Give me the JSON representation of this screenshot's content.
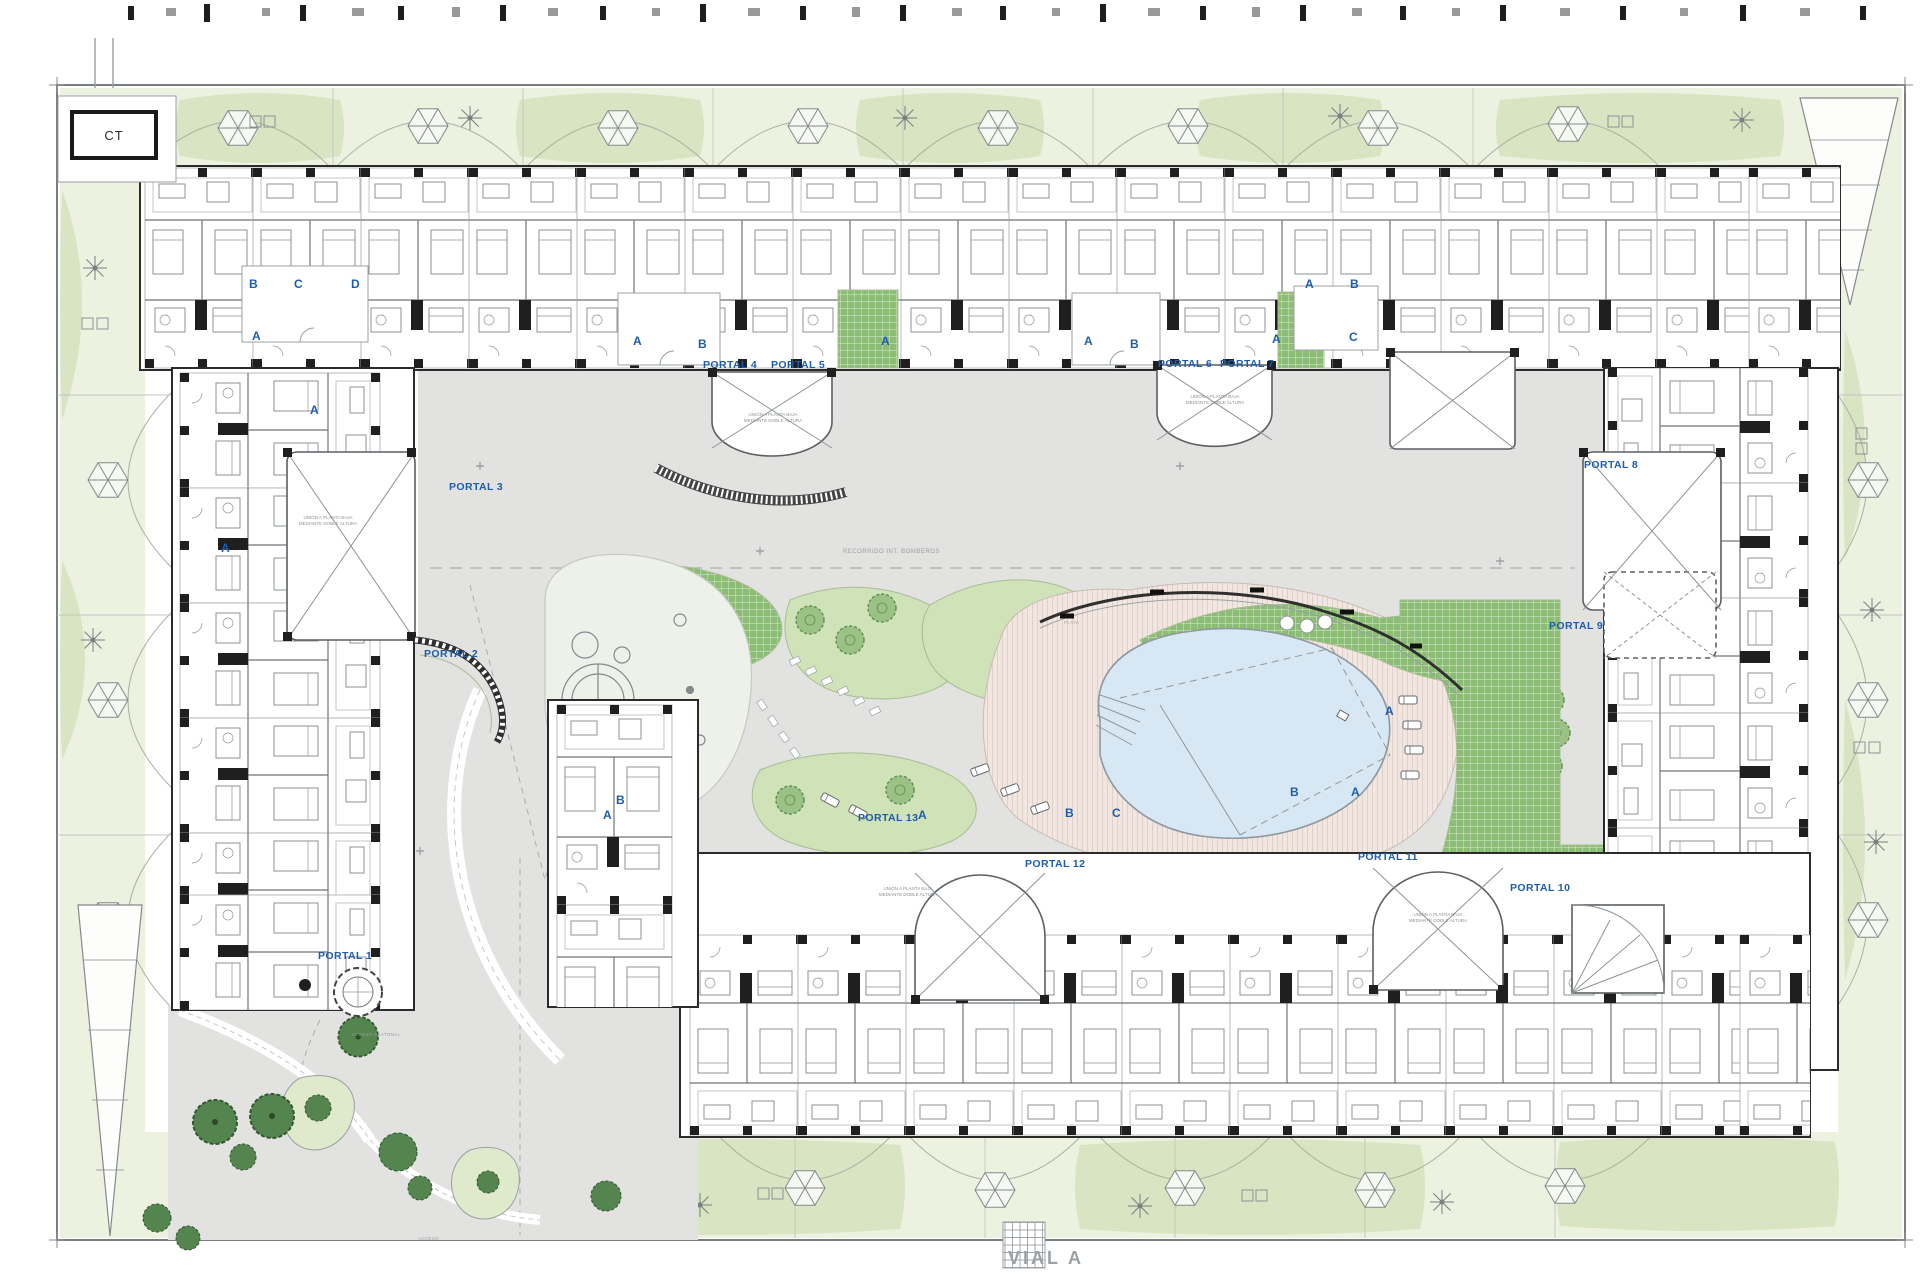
{
  "drawing": {
    "transformer_label": "CT",
    "road_label": "VIAL A",
    "access_label": "ACCESO",
    "pedestrian_access_label": "ACCESO PEATONAL",
    "fire_route_label": "RECORRIDO INT. BOMBEROS",
    "beach_label": "PLAYA",
    "double_height_note": "UNIÓN A PLANTA BAJA MEDIANTE DOBLE ALTURA",
    "portals": [
      {
        "label": "PORTAL 1"
      },
      {
        "label": "PORTAL 2"
      },
      {
        "label": "PORTAL 3"
      },
      {
        "label": "PORTAL 4"
      },
      {
        "label": "PORTAL 5"
      },
      {
        "label": "PORTAL 6"
      },
      {
        "label": "PORTAL 7"
      },
      {
        "label": "PORTAL 8"
      },
      {
        "label": "PORTAL 9"
      },
      {
        "label": "PORTAL 10"
      },
      {
        "label": "PORTAL 11"
      },
      {
        "label": "PORTAL 12"
      },
      {
        "label": "PORTAL 13"
      }
    ],
    "unit_letters": [
      {
        "label": "B"
      },
      {
        "label": "C"
      },
      {
        "label": "D"
      },
      {
        "label": "A"
      },
      {
        "label": "A"
      },
      {
        "label": "A"
      },
      {
        "label": "A"
      },
      {
        "label": "B"
      },
      {
        "label": "A"
      },
      {
        "label": "A"
      },
      {
        "label": "B"
      },
      {
        "label": "A"
      },
      {
        "label": "A"
      },
      {
        "label": "B"
      },
      {
        "label": "C"
      },
      {
        "label": "A"
      },
      {
        "label": "B"
      },
      {
        "label": "A"
      },
      {
        "label": "A"
      },
      {
        "label": "B"
      },
      {
        "label": "C"
      },
      {
        "label": "B"
      },
      {
        "label": "A"
      }
    ],
    "colors": {
      "portal_blue": "#1d5cae",
      "courtyard_gray": "#e2e3e1",
      "garden_light": "#ecf1e0",
      "lawn_grid_green": "#8cbd74",
      "pool_blue": "#d7e7f3",
      "deck_pink": "#f2e6e1",
      "wall_black": "#1f1f1f"
    }
  }
}
